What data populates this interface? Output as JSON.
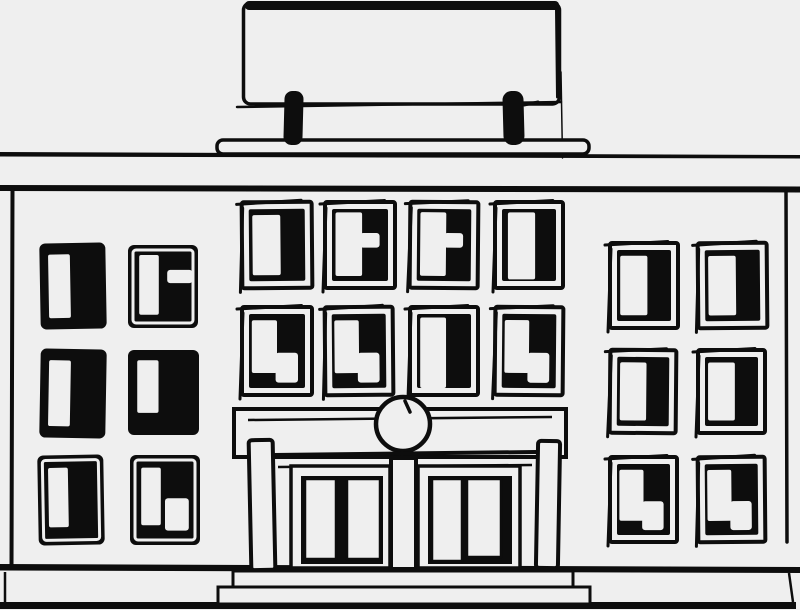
{
  "palette": {
    "background": "#efefef",
    "ink": "#0d0d0d"
  },
  "scene": {
    "description": "Black-and-white hand-drawn sketch of an institutional building facade: blank rooftop signboard on two posts, full-width roof cornice band, three sections of dark sketched windows (left wing 2x3, center 4x2, right wing 2x3), central entrance portico with round clock medallion, two columns, double doors, front steps and ground line.",
    "sign": {
      "x": 243,
      "y": 3,
      "w": 316,
      "h": 101
    },
    "roof_band": {
      "top_y": 153,
      "bottom_y": 187
    },
    "facade": {
      "left_x": 12,
      "right_x": 786,
      "top_y": 188,
      "bottom_y": 566
    },
    "window_variants": {
      "solid": {
        "style": "solid",
        "pane": [
          0.13,
          0.13,
          0.33,
          0.74
        ]
      },
      "solid-framed": {
        "style": "solid",
        "framed": true,
        "pane": [
          0.16,
          0.14,
          0.3,
          0.66
        ]
      },
      "solid-framed-notch": {
        "style": "solid",
        "framed": true,
        "pane": [
          0.16,
          0.12,
          0.28,
          0.72
        ],
        "notch": [
          0.56,
          0.3,
          0.36,
          0.16
        ]
      },
      "solid-corner": {
        "style": "solid",
        "framed": true,
        "pane": [
          0.16,
          0.14,
          0.28,
          0.64
        ],
        "corner": [
          0.5,
          0.48,
          0.34,
          0.36
        ]
      },
      "outline": {
        "style": "outline",
        "pane": [
          0.15,
          0.15,
          0.4,
          0.7
        ]
      },
      "outline-wide": {
        "style": "outline",
        "pane": [
          0.19,
          0.12,
          0.4,
          0.78
        ]
      },
      "outline-notch": {
        "style": "outline",
        "pane": [
          0.15,
          0.12,
          0.38,
          0.74
        ],
        "notch": [
          0.5,
          0.36,
          0.28,
          0.17
        ]
      },
      "outline-tall": {
        "style": "outline",
        "pane": [
          0.15,
          0.12,
          0.38,
          0.8
        ]
      },
      "outline-corner": {
        "style": "outline",
        "pane": [
          0.14,
          0.15,
          0.36,
          0.6
        ],
        "corner": [
          0.48,
          0.52,
          0.32,
          0.34
        ]
      }
    },
    "windows": [
      {
        "id": "left-r1c1",
        "x": 40,
        "y": 243,
        "w": 66,
        "h": 86,
        "variant": "solid",
        "rot": -1
      },
      {
        "id": "left-r1c2",
        "x": 128,
        "y": 245,
        "w": 70,
        "h": 83,
        "variant": "solid-framed-notch",
        "rot": 0
      },
      {
        "id": "left-r2c1",
        "x": 40,
        "y": 349,
        "w": 66,
        "h": 89,
        "variant": "solid",
        "rot": 1
      },
      {
        "id": "left-r2c2",
        "x": 128,
        "y": 350,
        "w": 71,
        "h": 85,
        "variant": "solid",
        "pane": [
          0.13,
          0.12,
          0.3,
          0.62
        ],
        "rot": 0
      },
      {
        "id": "left-r3c1",
        "x": 38,
        "y": 455,
        "w": 66,
        "h": 90,
        "variant": "solid-framed",
        "rot": -1
      },
      {
        "id": "left-r3c2",
        "x": 130,
        "y": 455,
        "w": 70,
        "h": 90,
        "variant": "solid-corner",
        "rot": 0
      },
      {
        "id": "center-r1c1",
        "x": 242,
        "y": 202,
        "w": 70,
        "h": 86,
        "variant": "outline",
        "rot": -0.5
      },
      {
        "id": "center-r1c2",
        "x": 325,
        "y": 202,
        "w": 70,
        "h": 86,
        "variant": "outline-notch",
        "rot": 0
      },
      {
        "id": "center-r1c3",
        "x": 410,
        "y": 202,
        "w": 68,
        "h": 86,
        "variant": "outline-notch",
        "rot": 0.5
      },
      {
        "id": "center-r1c4",
        "x": 495,
        "y": 202,
        "w": 68,
        "h": 86,
        "variant": "outline-wide",
        "rot": 0
      },
      {
        "id": "center-r2c1",
        "x": 242,
        "y": 307,
        "w": 70,
        "h": 88,
        "variant": "outline-corner",
        "rot": 0
      },
      {
        "id": "center-r2c2",
        "x": 325,
        "y": 307,
        "w": 68,
        "h": 88,
        "variant": "outline-corner",
        "rot": -0.5
      },
      {
        "id": "center-r2c3",
        "x": 410,
        "y": 307,
        "w": 68,
        "h": 88,
        "variant": "outline-tall",
        "rot": 0
      },
      {
        "id": "center-r2c4",
        "x": 495,
        "y": 307,
        "w": 68,
        "h": 88,
        "variant": "outline-corner",
        "rot": 0.5
      },
      {
        "id": "right-r1c1",
        "x": 610,
        "y": 243,
        "w": 68,
        "h": 85,
        "variant": "outline",
        "rot": 0
      },
      {
        "id": "right-r1c2",
        "x": 698,
        "y": 243,
        "w": 69,
        "h": 85,
        "variant": "outline",
        "rot": -0.5
      },
      {
        "id": "right-r2c1",
        "x": 610,
        "y": 350,
        "w": 66,
        "h": 83,
        "variant": "outline",
        "rot": 0.5
      },
      {
        "id": "right-r2c2",
        "x": 698,
        "y": 350,
        "w": 67,
        "h": 83,
        "variant": "outline",
        "rot": 0
      },
      {
        "id": "right-r3c1",
        "x": 610,
        "y": 457,
        "w": 67,
        "h": 85,
        "variant": "outline-corner",
        "rot": 0
      },
      {
        "id": "right-r3c2",
        "x": 698,
        "y": 457,
        "w": 67,
        "h": 85,
        "variant": "outline-corner",
        "rot": -0.5
      }
    ],
    "portico": {
      "entablature": {
        "x": 234,
        "y": 409,
        "w": 332,
        "h": 48
      },
      "clock": {
        "cx": 403,
        "cy": 424,
        "r": 27
      },
      "columns": [
        {
          "x": 250,
          "y": 440,
          "w": 24,
          "h": 130
        },
        {
          "x": 537,
          "y": 441,
          "w": 22,
          "h": 127
        }
      ],
      "pillar": {
        "x": 391,
        "y": 458,
        "w": 25,
        "h": 111
      },
      "doors": [
        {
          "x": 291,
          "y": 466,
          "w": 99,
          "h": 102
        },
        {
          "x": 418,
          "y": 466,
          "w": 102,
          "h": 102
        }
      ]
    },
    "steps": [
      {
        "x": 233,
        "y": 571,
        "w": 340,
        "h": 17
      },
      {
        "x": 218,
        "y": 587,
        "w": 372,
        "h": 17
      }
    ],
    "ground": {
      "y": 602,
      "h": 7
    }
  }
}
